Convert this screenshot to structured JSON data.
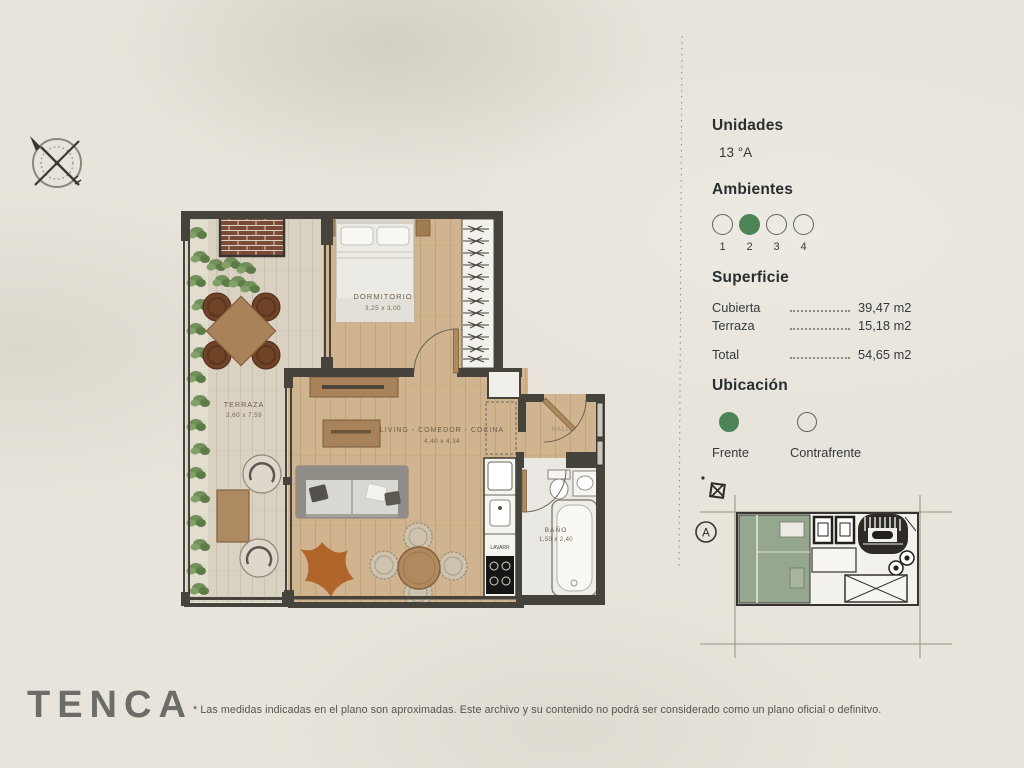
{
  "panel": {
    "unidades": {
      "title": "Unidades",
      "value": "13 °A"
    },
    "ambientes": {
      "title": "Ambientes",
      "options": [
        "1",
        "2",
        "3",
        "4"
      ],
      "selected": "2"
    },
    "superficie": {
      "title": "Superficie",
      "rows": [
        {
          "label": "Cubierta",
          "value": "39,47 m2"
        },
        {
          "label": "Terraza",
          "value": "15,18 m2"
        },
        {
          "label": "Total",
          "value": "54,65 m2"
        }
      ]
    },
    "ubicacion": {
      "title": "Ubicación",
      "options": [
        {
          "label": "Frente",
          "selected": true
        },
        {
          "label": "Contrafrente",
          "selected": false
        }
      ]
    }
  },
  "plan": {
    "rooms": [
      {
        "name": "TERRAZA",
        "dims": "2,60 x 7,59"
      },
      {
        "name": "DORMITORIO",
        "dims": "3,25 x 3,00"
      },
      {
        "name": "LIVING - COMEDOR - COCINA",
        "dims": "4,40 x 4,34"
      },
      {
        "name": "BAÑO",
        "dims": "1,50 x 2,40"
      },
      {
        "name": "HALL",
        "dims": ""
      },
      {
        "name": "LAVARR",
        "dims": ""
      }
    ]
  },
  "key_plan": {
    "label": "A"
  },
  "footer": {
    "logo": "TENCA",
    "disclaimer": "* Las medidas indicadas en el plano son aproximadas. Este archivo y su contenido no podrá ser considerado como un plano oficial o definitvo."
  },
  "colors": {
    "accent_green": "#4d8455",
    "key_plan_green": "#95a78f",
    "wall": "#46423c"
  }
}
